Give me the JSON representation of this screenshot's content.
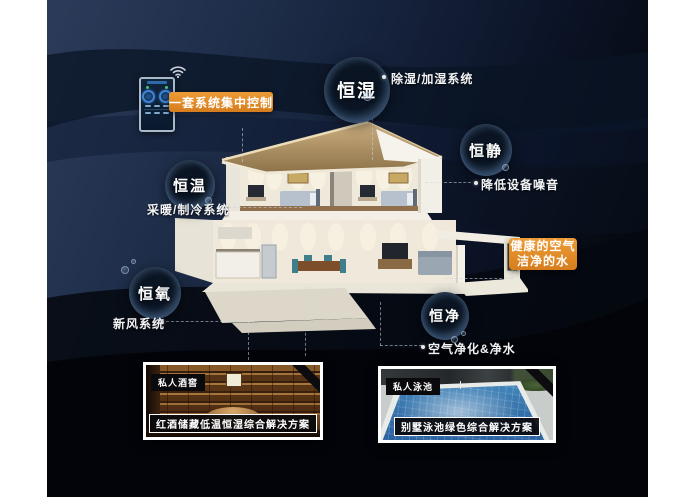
{
  "control_panel": {
    "badge": "一套系统集中控制"
  },
  "features": [
    {
      "name": "恒湿",
      "desc": "除湿/加湿系统"
    },
    {
      "name": "恒静",
      "desc": "降低设备噪音"
    },
    {
      "name": "恒温",
      "desc": "采暖/制冷系统"
    },
    {
      "name": "恒氧",
      "desc": "新风系统"
    },
    {
      "name": "恒净",
      "desc": "空气净化&净水"
    }
  ],
  "highlight_badge": {
    "line1": "健康的空气",
    "line2": "洁净的水"
  },
  "photos": [
    {
      "tag": "私人酒窖",
      "caption": "红酒储藏低温恒湿综合解决方案"
    },
    {
      "tag": "私人泳池",
      "caption": "别墅泳池绿色综合解决方案"
    }
  ],
  "colors": {
    "accent_orange": "#df8726",
    "background_navy": "#1c2a44",
    "bubble_text": "#ffffff"
  }
}
